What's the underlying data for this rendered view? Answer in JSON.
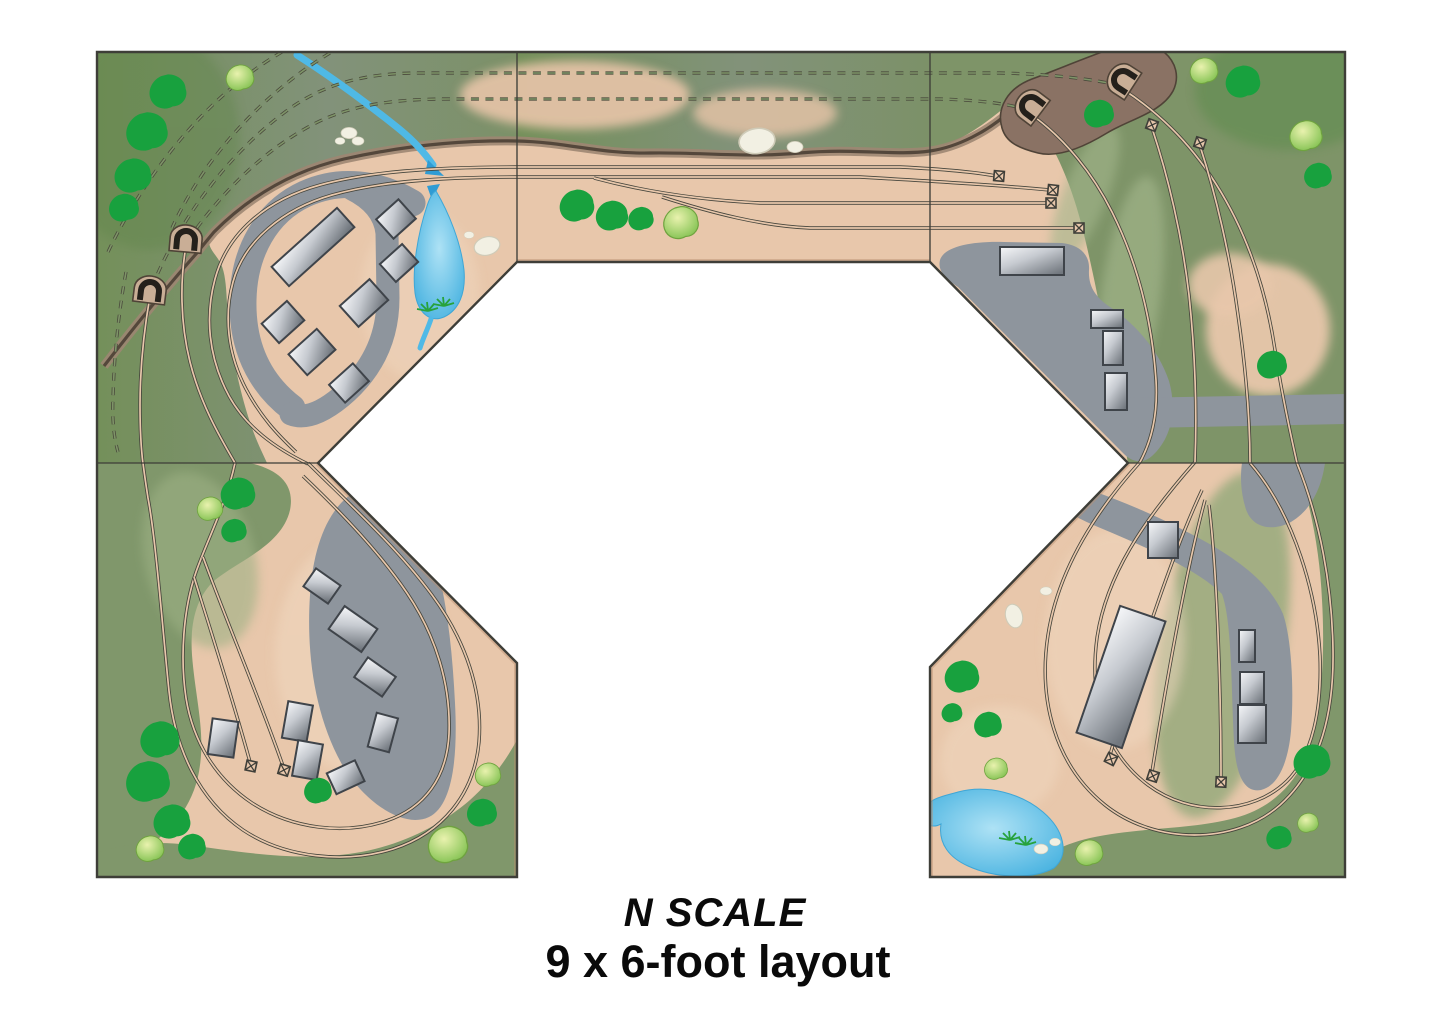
{
  "caption": {
    "line1": "N SCALE",
    "line2": "9 x 6-foot layout"
  },
  "palette": {
    "background": "#FFFFFF",
    "ground_tan": "#E8C7AB",
    "ground_light": "#F0D8C0",
    "grass_olive": "#7E9468",
    "grass_sage": "#9DB184",
    "grass_dark": "#5F8448",
    "tree_dark": "#18A13E",
    "tree_light": "#9CC653",
    "road_gray": "#8E959D",
    "building_fill_light": "#F4F5F7",
    "building_fill_dark": "#7A8088",
    "building_outline": "#3F444A",
    "track_line": "#45453C",
    "hidden_track_dash": "#4A4A3C",
    "ridge_brown": "#54473B",
    "portal_mound": "#C9AE96",
    "water_blue": "#54BCE8",
    "rock_white": "#F2F0E3",
    "border_line": "#3E3E38",
    "caption_text": "#0A0A0A"
  },
  "layout": {
    "shape": "U-shaped benchwork with open center operator pit"
  },
  "symbols": [
    "tunnel-portal",
    "hidden-track-dashed-line",
    "track-end-bumper",
    "town-building",
    "industrial-building",
    "deciduous-tree-dark",
    "deciduous-tree-light",
    "rock-outcrop",
    "stream-with-arrow",
    "teardrop-lake",
    "pond",
    "paved-road",
    "rock-ridge-cliff"
  ]
}
